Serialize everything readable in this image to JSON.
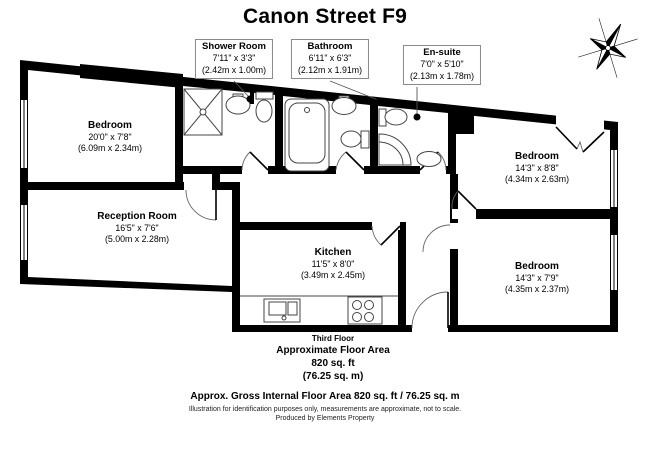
{
  "title": "Canon Street F9",
  "rooms": {
    "bedroom_tl": {
      "name": "Bedroom",
      "imperial": "20'0\" x 7'8\"",
      "metric": "(6.09m x 2.34m)"
    },
    "shower_room": {
      "name": "Shower Room",
      "imperial": "7'11\" x 3'3\"",
      "metric": "(2.42m x 1.00m)"
    },
    "bathroom": {
      "name": "Bathroom",
      "imperial": "6'11\" x 6'3\"",
      "metric": "(2.12m x 1.91m)"
    },
    "ensuite": {
      "name": "En-suite",
      "imperial": "7'0\" x 5'10\"",
      "metric": "(2.13m x 1.78m)"
    },
    "bedroom_right": {
      "name": "Bedroom",
      "imperial": "14'3\" x 8'8\"",
      "metric": "(4.34m x 2.63m)"
    },
    "bedroom_bottom": {
      "name": "Bedroom",
      "imperial": "14'3\" x 7'9\"",
      "metric": "(4.35m x 2.37m)"
    },
    "reception": {
      "name": "Reception Room",
      "imperial": "16'5\" x 7'6\"",
      "metric": "(5.00m x 2.28m)"
    },
    "kitchen": {
      "name": "Kitchen",
      "imperial": "11'5\" x 8'0\"",
      "metric": "(3.49m x 2.45m)"
    }
  },
  "floor_area": {
    "floor": "Third Floor",
    "line1": "Approximate Floor Area",
    "line2": "820 sq. ft",
    "line3": "(76.25 sq. m)"
  },
  "footer": {
    "gross": "Approx. Gross Internal Floor Area 820 sq. ft / 76.25 sq. m",
    "disclaimer": "Illustration for identification purposes only, measurements are approximate, not to scale.",
    "producer": "Produced by Elements Property"
  },
  "colors": {
    "wall": "#000000",
    "fixture_stroke": "#444444",
    "leader": "#555555"
  }
}
